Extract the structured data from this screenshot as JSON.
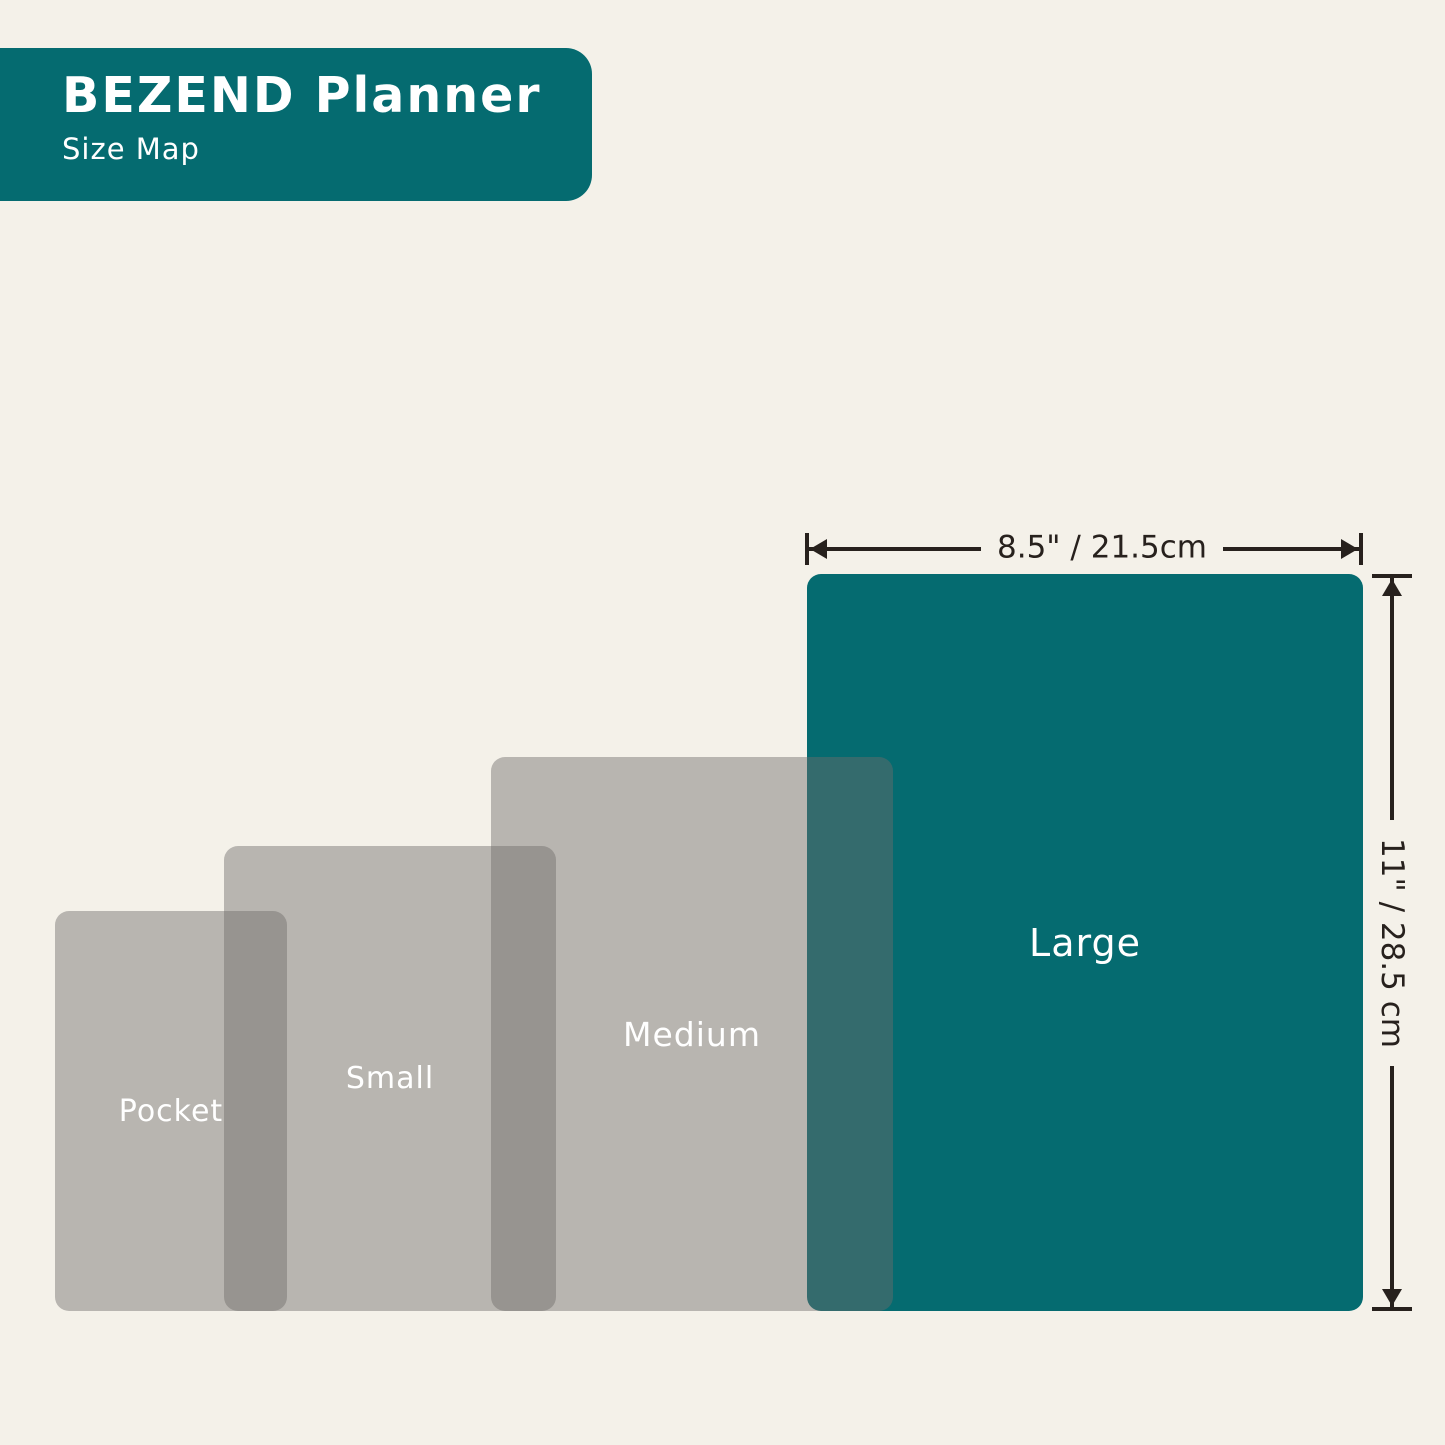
{
  "header": {
    "title": "BEZEND Planner",
    "subtitle": "Size Map"
  },
  "sizes": [
    {
      "id": "pocket",
      "label": "Pocket",
      "highlighted": false
    },
    {
      "id": "small",
      "label": "Small",
      "highlighted": false
    },
    {
      "id": "medium",
      "label": "Medium",
      "highlighted": false
    },
    {
      "id": "large",
      "label": "Large",
      "highlighted": true
    }
  ],
  "dimensions": {
    "width_label": "8.5\" / 21.5cm",
    "height_label": "11\" / 28.5 cm"
  },
  "colors": {
    "background": "#f4f1e9",
    "teal_accent": "#056b70",
    "ink": "#27211d",
    "planner_gray": "rgba(110,109,107,0.45)",
    "label_text": "#ffffff"
  }
}
